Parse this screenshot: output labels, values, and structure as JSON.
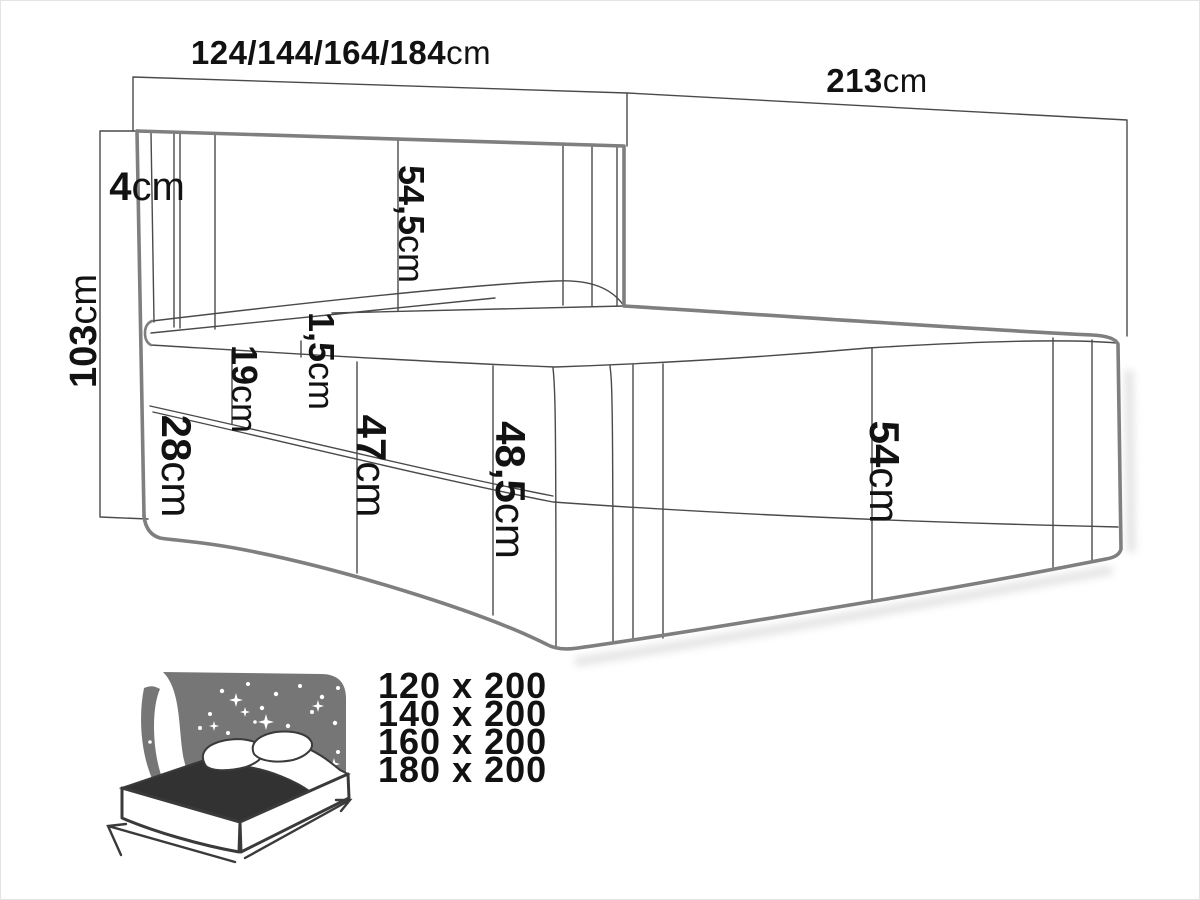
{
  "diagram": {
    "title_semantic": "boxspring-bed-dimension-diagram",
    "dimensions": {
      "width": {
        "value": "124/144/164/184",
        "unit": "cm"
      },
      "length": {
        "value": "213",
        "unit": "cm"
      },
      "height": {
        "value": "103",
        "unit": "cm"
      },
      "headboard_thickness": {
        "value": "4",
        "unit": "cm"
      },
      "headboard_height": {
        "value": "54,5",
        "unit": "cm"
      },
      "topper_height": {
        "value": "1,5",
        "unit": "cm"
      },
      "mattress_height": {
        "value": "19",
        "unit": "cm"
      },
      "base_height": {
        "value": "28",
        "unit": "cm"
      },
      "side_height": {
        "value": "47",
        "unit": "cm"
      },
      "side_total_height": {
        "value": "48,5",
        "unit": "cm"
      },
      "foot_height": {
        "value": "54",
        "unit": "cm"
      }
    },
    "colors": {
      "outline_thick": "#7f7f7f",
      "outline_thin": "#4a4a4a",
      "label_text": "#121212",
      "sizes_text": "#6a6a6a",
      "icon_fill": "#767676",
      "icon_dark": "#323232",
      "icon_line": "#3a3a3a"
    }
  },
  "sizes_list": {
    "items": [
      "120 x 200",
      "140 x 200",
      "160 x 200",
      "180 x 200"
    ]
  }
}
